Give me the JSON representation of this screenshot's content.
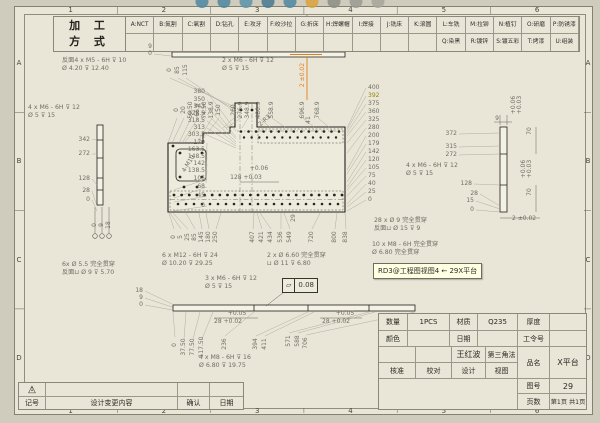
{
  "toolbar": {
    "icons": [
      {
        "name": "zoom-area-icon",
        "color": "#4e86a0"
      },
      {
        "name": "zoom-fit-icon",
        "color": "#4e86a0"
      },
      {
        "name": "zoom-in-out-icon",
        "color": "#5b93ab"
      },
      {
        "name": "rotate-view-icon",
        "color": "#46788f"
      },
      {
        "name": "pan-icon",
        "color": "#4e86a0"
      },
      {
        "name": "shaded-view-icon",
        "color": "#d9a23c"
      },
      {
        "name": "view-orientation-icon",
        "color": "#8d8d85"
      },
      {
        "name": "section-view-icon",
        "color": "#9a9a92"
      },
      {
        "name": "hide-show-icon",
        "color": "#a5a59b"
      }
    ]
  },
  "process_table": {
    "title_line1": "加 工",
    "title_line2": "方 式",
    "row1": [
      "A:NCT",
      "B:氮割",
      "C:氧割",
      "D:钻孔",
      "E:攻牙",
      "F:绞沙拉",
      "G:折床",
      "H:焊螺帽",
      "I:焊接",
      "J:铣床",
      "K:滚圆",
      "L:车铣",
      "M:拉铆",
      "N:植钉",
      "O:研磨",
      "P:防锈漆"
    ],
    "row2_offset": 11,
    "row2": [
      "Q:染黑",
      "R:镀锌",
      "S:镀五彩锌",
      "T:烤漆",
      "U:组装"
    ]
  },
  "sheet_zones": {
    "columns": [
      "1",
      "2",
      "3",
      "4",
      "5",
      "6"
    ],
    "rows": [
      "A",
      "B",
      "C",
      "D"
    ]
  },
  "tooltip": {
    "text": "RD3@工程图视图4 ← 29X平台",
    "bg": "#ffffe1"
  },
  "gdt_frame": {
    "symbol": "▱",
    "value": "0.08"
  },
  "accent_colors": {
    "selected_dim": "#e0801a",
    "highlight_dim": "#94840a"
  },
  "dimensions": [
    {
      "t": "380",
      "x": 205,
      "y": 92,
      "a": "r",
      "lx": 236,
      "ly": 131
    },
    {
      "t": "350",
      "x": 205,
      "y": 100,
      "a": "r",
      "lx": 236,
      "ly": 137
    },
    {
      "t": "343",
      "x": 205,
      "y": 107,
      "a": "r",
      "lx": 236,
      "ly": 139
    },
    {
      "t": "328.5",
      "x": 205,
      "y": 114,
      "a": "r",
      "lx": 236,
      "ly": 142
    },
    {
      "t": "318.5",
      "x": 205,
      "y": 121,
      "a": "r",
      "lx": 236,
      "ly": 144
    },
    {
      "t": "313",
      "x": 205,
      "y": 128,
      "a": "r",
      "lx": 236,
      "ly": 146
    },
    {
      "t": "303.5",
      "x": 205,
      "y": 135,
      "a": "r",
      "lx": 236,
      "ly": 148
    },
    {
      "t": "179",
      "x": 205,
      "y": 143,
      "a": "r",
      "lx": 206,
      "ly": 174
    },
    {
      "t": "163.5",
      "x": 205,
      "y": 150,
      "a": "r",
      "lx": 206,
      "ly": 177
    },
    {
      "t": "148.5",
      "x": 205,
      "y": 157,
      "a": "r",
      "lx": 206,
      "ly": 180
    },
    {
      "t": "142",
      "x": 205,
      "y": 164,
      "a": "r",
      "lx": 206,
      "ly": 182
    },
    {
      "t": "138.5",
      "x": 205,
      "y": 171,
      "a": "r",
      "lx": 206,
      "ly": 183
    },
    {
      "t": "105",
      "x": 205,
      "y": 179,
      "a": "r",
      "lx": 174,
      "ly": 190
    },
    {
      "t": "68",
      "x": 205,
      "y": 187,
      "a": "r",
      "lx": 174,
      "ly": 198
    },
    {
      "t": "45",
      "x": 205,
      "y": 196,
      "a": "r",
      "lx": 174,
      "ly": 202
    },
    {
      "t": "0",
      "x": 205,
      "y": 206,
      "a": "r",
      "lx": 174,
      "ly": 211
    },
    {
      "t": "400",
      "x": 368,
      "y": 88,
      "a": "l",
      "lx": 347,
      "ly": 128
    },
    {
      "t": "392",
      "x": 368,
      "y": 96,
      "a": "l",
      "c": "#94840a",
      "lx": 347,
      "ly": 130
    },
    {
      "t": "375",
      "x": 368,
      "y": 104,
      "a": "l",
      "lx": 347,
      "ly": 133
    },
    {
      "t": "360",
      "x": 368,
      "y": 112,
      "a": "l",
      "lx": 347,
      "ly": 136
    },
    {
      "t": "325",
      "x": 368,
      "y": 120,
      "a": "l",
      "lx": 347,
      "ly": 143
    },
    {
      "t": "280",
      "x": 368,
      "y": 128,
      "a": "l",
      "lx": 347,
      "ly": 153
    },
    {
      "t": "200",
      "x": 368,
      "y": 136,
      "a": "l",
      "lx": 347,
      "ly": 170
    },
    {
      "t": "179",
      "x": 368,
      "y": 144,
      "a": "l",
      "lx": 347,
      "ly": 174
    },
    {
      "t": "142",
      "x": 368,
      "y": 152,
      "a": "l",
      "lx": 347,
      "ly": 182
    },
    {
      "t": "120",
      "x": 368,
      "y": 160,
      "a": "l",
      "lx": 347,
      "ly": 187
    },
    {
      "t": "105",
      "x": 368,
      "y": 168,
      "a": "l",
      "lx": 347,
      "ly": 190
    },
    {
      "t": "75",
      "x": 368,
      "y": 176,
      "a": "l",
      "lx": 347,
      "ly": 196
    },
    {
      "t": "40",
      "x": 368,
      "y": 184,
      "a": "l",
      "lx": 347,
      "ly": 204
    },
    {
      "t": "25",
      "x": 368,
      "y": 192,
      "a": "l",
      "lx": 347,
      "ly": 207
    },
    {
      "t": "0",
      "x": 368,
      "y": 200,
      "a": "l",
      "lx": 347,
      "ly": 211
    },
    {
      "t": "0",
      "x": 177,
      "y": 110,
      "r": -90,
      "lx": 168,
      "ly": 143
    },
    {
      "t": "20",
      "x": 184,
      "y": 110,
      "r": -90,
      "lx": 172,
      "ly": 143
    },
    {
      "t": "50.50",
      "x": 191,
      "y": 110,
      "r": -90,
      "lx": 179,
      "ly": 143
    },
    {
      "t": "66.9",
      "x": 198,
      "y": 110,
      "r": -90,
      "lx": 182,
      "ly": 143
    },
    {
      "t": "74.50",
      "x": 205,
      "y": 110,
      "r": -90,
      "lx": 184,
      "ly": 143
    },
    {
      "t": "138.9",
      "x": 212,
      "y": 110,
      "r": -90,
      "lx": 197,
      "ly": 143
    },
    {
      "t": "150",
      "x": 219,
      "y": 110,
      "r": -90,
      "lx": 200,
      "ly": 143
    },
    {
      "t": "260",
      "x": 234,
      "y": 110,
      "r": -90,
      "lx": 223,
      "ly": 128
    },
    {
      "t": "276.9",
      "x": 241,
      "y": 110,
      "r": -90,
      "lx": 226,
      "ly": 128
    },
    {
      "t": "348.9",
      "x": 248,
      "y": 110,
      "r": -90,
      "lx": 242,
      "ly": 128
    },
    {
      "t": "486.9",
      "x": 259,
      "y": 110,
      "r": -90,
      "lx": 271,
      "ly": 128
    },
    {
      "t": "558.9",
      "x": 272,
      "y": 110,
      "r": -90,
      "lx": 286,
      "ly": 128
    },
    {
      "t": "696.9",
      "x": 303,
      "y": 110,
      "r": -90,
      "lx": 315,
      "ly": 128
    },
    {
      "t": "768.9",
      "x": 318,
      "y": 110,
      "r": -90,
      "lx": 330,
      "ly": 128
    },
    {
      "t": "0",
      "x": 170,
      "y": 70,
      "r": -90,
      "lx": 235,
      "ly": 107
    },
    {
      "t": "85",
      "x": 178,
      "y": 70,
      "r": -90,
      "lx": 236,
      "ly": 110
    },
    {
      "t": "115",
      "x": 186,
      "y": 70,
      "r": -90,
      "lx": 237,
      "ly": 113
    },
    {
      "t": "0",
      "x": 174,
      "y": 237,
      "r": -90,
      "lx": 169,
      "ly": 213
    },
    {
      "t": "5",
      "x": 181,
      "y": 237,
      "r": -90,
      "lx": 170,
      "ly": 213
    },
    {
      "t": "25",
      "x": 188,
      "y": 237,
      "r": -90,
      "lx": 173,
      "ly": 213
    },
    {
      "t": "85",
      "x": 195,
      "y": 237,
      "r": -90,
      "lx": 186,
      "ly": 213
    },
    {
      "t": "145",
      "x": 202,
      "y": 237,
      "r": -90,
      "lx": 199,
      "ly": 213
    },
    {
      "t": "180",
      "x": 209,
      "y": 237,
      "r": -90,
      "lx": 206,
      "ly": 213
    },
    {
      "t": "250",
      "x": 216,
      "y": 237,
      "r": -90,
      "lx": 221,
      "ly": 213
    },
    {
      "t": "407",
      "x": 253,
      "y": 237,
      "r": -90,
      "lx": 254,
      "ly": 213
    },
    {
      "t": "421",
      "x": 262,
      "y": 237,
      "r": -90,
      "lx": 257,
      "ly": 213
    },
    {
      "t": "434",
      "x": 271,
      "y": 237,
      "r": -90,
      "lx": 260,
      "ly": 213
    },
    {
      "t": "536",
      "x": 281,
      "y": 237,
      "r": -90,
      "lx": 281,
      "ly": 213
    },
    {
      "t": "549",
      "x": 290,
      "y": 237,
      "r": -90,
      "lx": 284,
      "ly": 213
    },
    {
      "t": "720",
      "x": 312,
      "y": 237,
      "r": -90,
      "lx": 320,
      "ly": 213
    },
    {
      "t": "800",
      "x": 335,
      "y": 237,
      "r": -90,
      "lx": 337,
      "ly": 213
    },
    {
      "t": "838",
      "x": 346,
      "y": 237,
      "r": -90,
      "lx": 345,
      "ly": 213
    },
    {
      "t": "342",
      "x": 90,
      "y": 140,
      "a": "r",
      "lx": 97,
      "ly": 139
    },
    {
      "t": "272",
      "x": 90,
      "y": 154,
      "a": "r",
      "lx": 97,
      "ly": 154
    },
    {
      "t": "128",
      "x": 90,
      "y": 179,
      "a": "r",
      "lx": 97,
      "ly": 185
    },
    {
      "t": "28",
      "x": 90,
      "y": 191,
      "a": "r",
      "lx": 97,
      "ly": 206
    },
    {
      "t": "0",
      "x": 90,
      "y": 200,
      "a": "r",
      "lx": 97,
      "ly": 211
    },
    {
      "t": "0",
      "x": 95,
      "y": 225,
      "r": -90
    },
    {
      "t": "9",
      "x": 102,
      "y": 225,
      "r": -90
    },
    {
      "t": "18",
      "x": 109,
      "y": 225,
      "r": -90
    },
    {
      "t": "372",
      "x": 457,
      "y": 134,
      "a": "r",
      "lx": 500,
      "ly": 133
    },
    {
      "t": "315",
      "x": 457,
      "y": 147,
      "a": "r",
      "lx": 500,
      "ly": 146
    },
    {
      "t": "272",
      "x": 457,
      "y": 155,
      "a": "r",
      "lx": 500,
      "ly": 154
    },
    {
      "t": "128",
      "x": 472,
      "y": 184,
      "a": "r",
      "lx": 500,
      "ly": 185
    },
    {
      "t": "28",
      "x": 478,
      "y": 194,
      "a": "r",
      "lx": 500,
      "ly": 206
    },
    {
      "t": "15",
      "x": 474,
      "y": 201,
      "a": "r",
      "lx": 500,
      "ly": 209
    },
    {
      "t": "0",
      "x": 474,
      "y": 210,
      "a": "r",
      "lx": 500,
      "ly": 212
    },
    {
      "t": "9",
      "x": 497,
      "y": 119
    },
    {
      "t": "+0.06",
      "x": 514,
      "y": 105,
      "r": -90
    },
    {
      "t": "+0.03",
      "x": 520,
      "y": 105,
      "r": -90
    },
    {
      "t": "70",
      "x": 530,
      "y": 131,
      "r": -90
    },
    {
      "t": "+0.06",
      "x": 524,
      "y": 169,
      "r": -90
    },
    {
      "t": "+0.03",
      "x": 530,
      "y": 169,
      "r": -90
    },
    {
      "t": "70",
      "x": 530,
      "y": 192,
      "r": -90
    },
    {
      "t": "2 ±0.02",
      "x": 512,
      "y": 219,
      "a": "l"
    },
    {
      "t": "9",
      "x": 152,
      "y": 47,
      "a": "r",
      "lx": 171,
      "ly": 52
    },
    {
      "t": "0",
      "x": 152,
      "y": 54,
      "a": "r",
      "lx": 171,
      "ly": 56
    },
    {
      "t": "41",
      "x": 309,
      "y": 120,
      "r": -90
    },
    {
      "t": "2 ±0.02",
      "x": 303,
      "y": 75,
      "r": -90,
      "c": "#e0801a"
    },
    {
      "t": "2-R3",
      "x": 265,
      "y": 121,
      "r": -42
    },
    {
      "t": "4-M10",
      "x": 189,
      "y": 164,
      "r": -58
    },
    {
      "t": "+0.06",
      "x": 259,
      "y": 169
    },
    {
      "t": "128 +0.03",
      "x": 246,
      "y": 178
    },
    {
      "t": "29",
      "x": 294,
      "y": 218,
      "r": -90
    },
    {
      "t": "18",
      "x": 143,
      "y": 291,
      "a": "r",
      "lx": 172,
      "ly": 304
    },
    {
      "t": "9",
      "x": 143,
      "y": 298,
      "a": "r",
      "lx": 172,
      "ly": 307
    },
    {
      "t": "0",
      "x": 143,
      "y": 305,
      "a": "r",
      "lx": 172,
      "ly": 310
    },
    {
      "t": "0",
      "x": 175,
      "y": 345,
      "r": -90,
      "lx": 173,
      "ly": 312
    },
    {
      "t": "37.50",
      "x": 184,
      "y": 347,
      "r": -90,
      "lx": 186,
      "ly": 312
    },
    {
      "t": "77.50",
      "x": 193,
      "y": 347,
      "r": -90,
      "lx": 200,
      "ly": 312
    },
    {
      "t": "117.50",
      "x": 202,
      "y": 347,
      "r": -90,
      "lx": 213,
      "ly": 312
    },
    {
      "t": "236",
      "x": 225,
      "y": 344,
      "r": -90,
      "lx": 254,
      "ly": 312
    },
    {
      "t": "394",
      "x": 256,
      "y": 344,
      "r": -90,
      "lx": 308,
      "ly": 312
    },
    {
      "t": "411",
      "x": 265,
      "y": 344,
      "r": -90,
      "lx": 314,
      "ly": 312
    },
    {
      "t": "571",
      "x": 289,
      "y": 341,
      "r": -90,
      "lx": 369,
      "ly": 312
    },
    {
      "t": "588",
      "x": 298,
      "y": 341,
      "r": -90,
      "lx": 375,
      "ly": 312
    },
    {
      "t": "706",
      "x": 306,
      "y": 343,
      "r": -90,
      "lx": 415,
      "ly": 312
    },
    {
      "t": "+0.05",
      "x": 237,
      "y": 314
    },
    {
      "t": "28 +0.02",
      "x": 228,
      "y": 322
    },
    {
      "t": "+0.05",
      "x": 345,
      "y": 314
    },
    {
      "t": "28 +0.02",
      "x": 336,
      "y": 322
    }
  ],
  "callouts": [
    {
      "x": 62,
      "y": 57,
      "l1": "反面4 x M5 - 6H ⊽ 10",
      "l2": "Ø 4.20 ⊽ 12.40"
    },
    {
      "x": 222,
      "y": 57,
      "l1": "2 x M6 - 6H ⊽ 12",
      "l2": "Ø 5 ⊽ 15"
    },
    {
      "x": 28,
      "y": 104,
      "l1": "4 x M6 - 6H ⊽ 12",
      "l2": "Ø 5 ⊽ 15"
    },
    {
      "x": 62,
      "y": 261,
      "l1": "6x Ø 5.5 完全贯穿",
      "l2": "反面⊔ Ø 9 ⊽ 5.70"
    },
    {
      "x": 162,
      "y": 252,
      "l1": "6 x M12 - 6H ⊽ 24",
      "l2": "Ø 10.20 ⊽ 29.25"
    },
    {
      "x": 267,
      "y": 252,
      "l1": "2 x Ø 6.60 完全贯穿",
      "l2": "⊔ Ø 11 ⊽ 6.80"
    },
    {
      "x": 205,
      "y": 275,
      "l1": "3 x M6 - 6H ⊽ 12",
      "l2": "Ø 5 ⊽ 15"
    },
    {
      "x": 374,
      "y": 217,
      "l1": "28 x Ø 9 完全贯穿",
      "l2": "反面⊔ Ø 15 ⊽ 9"
    },
    {
      "x": 372,
      "y": 241,
      "l1": "10 x M8 - 6H 完全贯穿",
      "l2": "Ø 6.80 完全贯穿"
    },
    {
      "x": 406,
      "y": 162,
      "l1": "4 x M6 - 6H ⊽ 12",
      "l2": "Ø 5 ⊽ 15"
    },
    {
      "x": 199,
      "y": 354,
      "l1": "4 x M8 - 6H ⊽ 16",
      "l2": "Ø 6.80 ⊽ 19.75"
    }
  ],
  "holes": {
    "rows": [
      {
        "y": 131.5,
        "x0": 241,
        "x1": 339,
        "n": 14,
        "rad": 1.3
      },
      {
        "y": 137.5,
        "x0": 244,
        "x1": 336,
        "n": 13,
        "rad": 1.2
      },
      {
        "y": 195,
        "x0": 174,
        "x1": 342,
        "n": 23,
        "rad": 1.4
      },
      {
        "y": 204,
        "x0": 178,
        "x1": 338,
        "n": 21,
        "rad": 1.3
      }
    ],
    "dots": [
      [
        180,
        153
      ],
      [
        202,
        153
      ],
      [
        180,
        177
      ],
      [
        202,
        177
      ],
      [
        184,
        187
      ],
      [
        197,
        187
      ],
      [
        241,
        110
      ],
      [
        252,
        110
      ],
      [
        173,
        146
      ]
    ],
    "open_circles": [
      [
        95,
        236
      ],
      [
        102,
        236
      ],
      [
        109,
        236
      ]
    ]
  },
  "title_block": {
    "qty_label": "数量",
    "qty": "1PCS",
    "material_label": "材质",
    "material": "Q235",
    "thickness_label": "厚度",
    "thickness": "",
    "color_label": "颜色",
    "color": "",
    "date_label": "日期",
    "date": "",
    "work_order_label": "工令号",
    "work_order": "",
    "designer_name": "王红波",
    "projection": "第三角法",
    "approve_label": "核准",
    "check_label": "校对",
    "design_label": "设计",
    "view_label": "视图",
    "product_label": "品名",
    "product": "X平台",
    "drawing_no_label": "图号",
    "drawing_no": "29",
    "pages_label": "页数",
    "pages": "第1页 共1页"
  },
  "revision_table": {
    "marker": "1",
    "sign_label": "记号",
    "change_label": "设计变更内容",
    "confirm_label": "确认",
    "date_label": "日期"
  }
}
